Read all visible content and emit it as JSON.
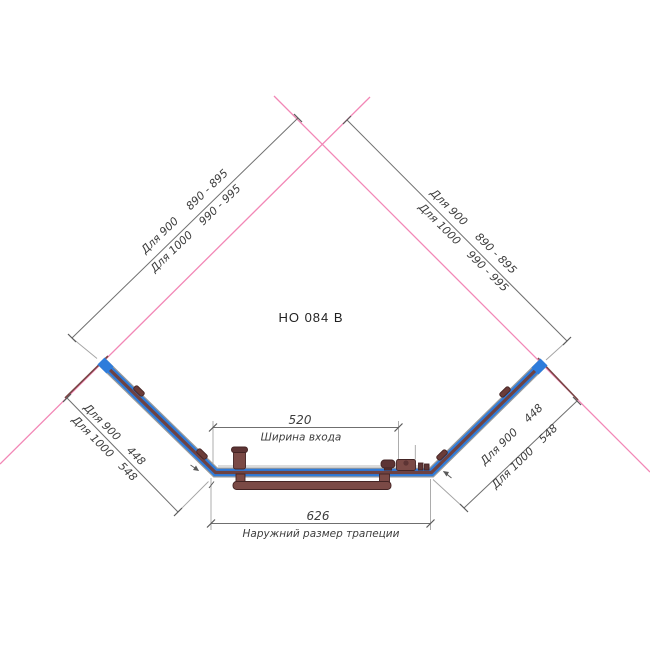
{
  "title": "HO 084 B",
  "colors": {
    "glass_blue": "#2e7cdb",
    "frame_maroon": "#6e4242",
    "wall_pink": "#f287b6",
    "wall_profile": "#7a4545",
    "hardware": "#7b4a46",
    "hardware_dark": "#5d3434",
    "clip": "#6b3c38"
  },
  "dimensions": {
    "top_left": {
      "rows": [
        {
          "label": "Для 900",
          "value": "890 - 895"
        },
        {
          "label": "Для 1000",
          "value": "990 - 995"
        }
      ]
    },
    "top_right": {
      "rows": [
        {
          "label": "Для 900",
          "value": "890 - 895"
        },
        {
          "label": "Для 1000",
          "value": "990 - 995"
        }
      ]
    },
    "side_left": {
      "rows": [
        {
          "label": "Для 900",
          "value": "448"
        },
        {
          "label": "Для 1000",
          "value": "548"
        }
      ]
    },
    "side_right": {
      "rows": [
        {
          "label": "Для 900",
          "value": "448"
        },
        {
          "label": "Для 1000",
          "value": "548"
        }
      ]
    },
    "entrance": {
      "value": "520",
      "label": "Ширина входа"
    },
    "outer": {
      "value": "626",
      "label": "Наружний размер трапеции"
    }
  }
}
